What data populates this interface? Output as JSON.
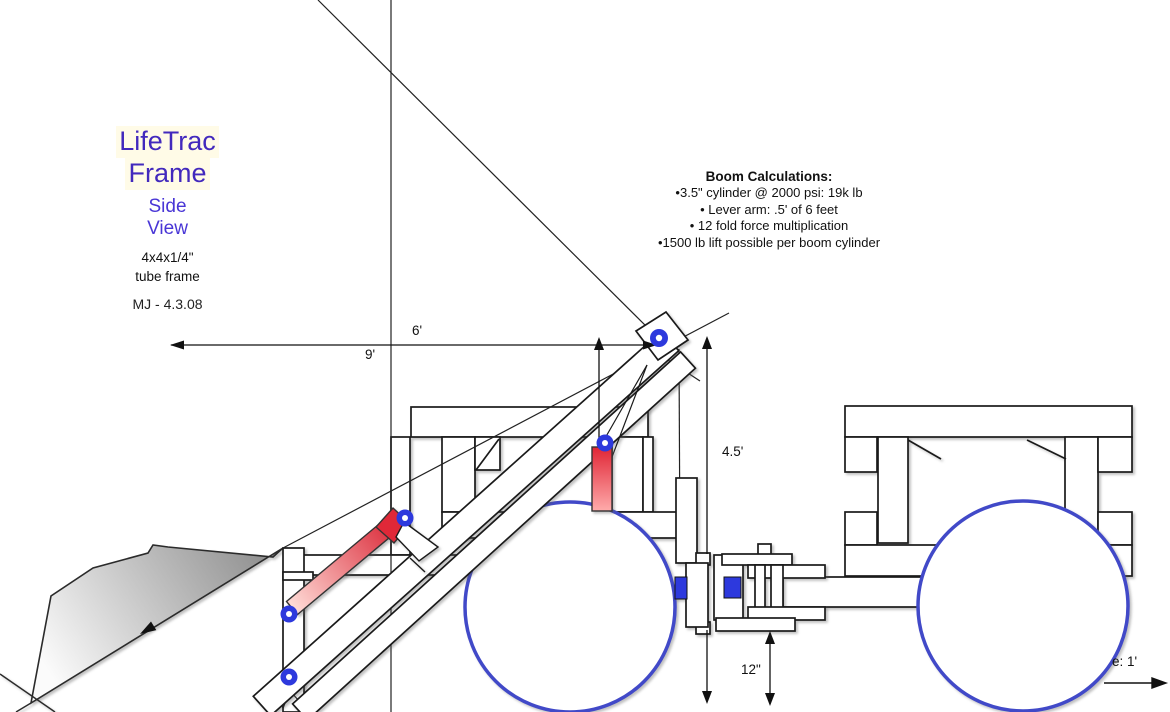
{
  "page": {
    "width": 1170,
    "height": 712,
    "background": "#ffffff"
  },
  "title_block": {
    "title_line1": "LifeTrac",
    "title_line2": "Frame",
    "view_line1": "Side",
    "view_line2": "View",
    "spec_line1": "4x4x1/4\"",
    "spec_line2": "tube frame",
    "author_date": "MJ - 4.3.08"
  },
  "boom_calculations": {
    "heading": "Boom Calculations:",
    "items": [
      "•3.5\" cylinder @ 2000 psi:  19k lb",
      "• Lever arm: .5' of 6 feet",
      "• 12 fold force multiplication",
      "•1500 lb lift possible per boom cylinder"
    ]
  },
  "dimensions": {
    "boom_reach_6ft": "6'",
    "overall_reach_9ft": "9'",
    "boom_height_4_5ft": "4.5'",
    "hitch_clearance_12in": "12\"",
    "scale_label_visible": "e: 1'"
  },
  "drawing": {
    "components": [
      "bucket",
      "boom-arm",
      "boom-lift-cylinder",
      "bucket-cylinder",
      "front-frame",
      "rear-frame",
      "articulation-coupler",
      "front-wheel",
      "rear-wheel",
      "pivot-joints",
      "dimension-arrows"
    ],
    "colors": {
      "pivot_blue": "#2d39dd",
      "wheel_stroke": "#4149c8",
      "cylinder_red": "#d92232",
      "title_purple": "#4229bd",
      "view_blue": "#4936d6",
      "bucket_gray": "#8f8f8f"
    }
  }
}
